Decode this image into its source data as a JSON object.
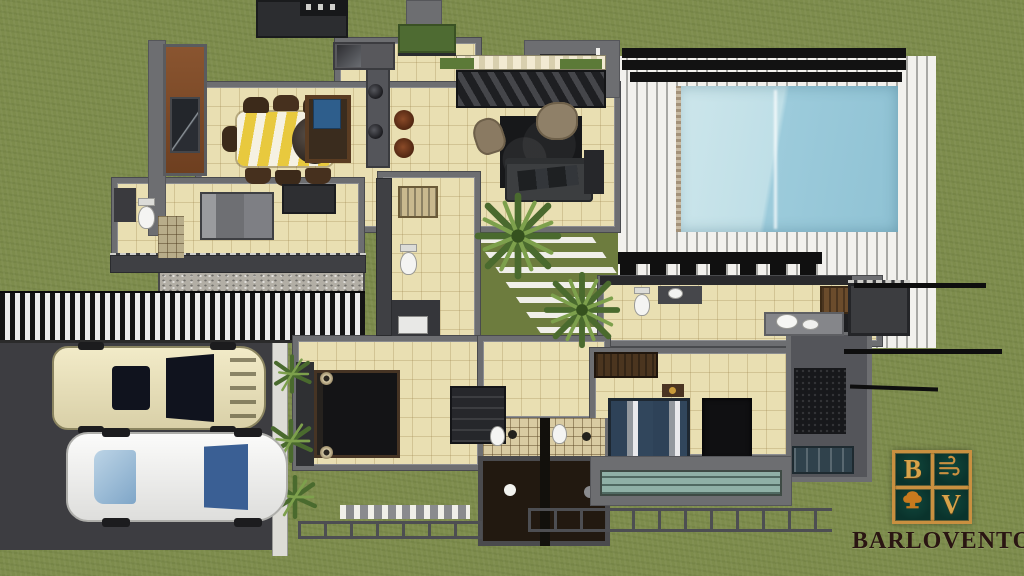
{
  "scene": {
    "description": "Aerial 3D top-down render of a single-storey house floor plan with swimming pool, wood deck, inner courtyard, driveway and two parked cars",
    "render_width": 1024,
    "render_height": 576
  },
  "brand": {
    "wordmark": "BARLOVENTO",
    "monogram": [
      "B",
      "V"
    ],
    "colors": {
      "panel": "#0a332c",
      "gold": "#c99040",
      "tree_orange": "#c87a1e",
      "wordmark": "#2a1512"
    }
  },
  "palette": {
    "grass": "#7d8c4c",
    "courtyard_grass": "#6d7c3e",
    "asphalt": "#3d3d41",
    "sidewalk": "#dddcd6",
    "gravel": "#b2aea5",
    "floor_tile": "#e9dfb2",
    "wall_gray": "#6d6e71",
    "wall_dark": "#3f4044",
    "roof_dark": "#2c2d30",
    "deck_white": "#f2f1ed",
    "pergola_black": "#121212",
    "pool_shallow": "#c6e1e8",
    "pool_deep": "#8fc2d4",
    "bath_floor_dark": "#221910",
    "tile_wall_beige": "#d9cba2",
    "wood_cabinet": "#6b4c2c",
    "accent_wall_brown": "#7a4a28",
    "rug_black": "#17181a",
    "sofa_gray": "#3c3e40",
    "chair_tan": "#8a7a62",
    "bed_black": "#141416",
    "bed_gray": "#7e7f84",
    "bed_blue": "#2e4258",
    "island_blue": "#2e5e8c",
    "table_yellow": "#e8c93e",
    "table_cream": "#f5f1e2",
    "car_cream": "#ece4bf",
    "car_white": "#f4f4f2",
    "glass_windshield_dark": "#10131e",
    "glass_windshield_blue": "#3a5f94",
    "skylight_teal": "#8fb0a6"
  }
}
